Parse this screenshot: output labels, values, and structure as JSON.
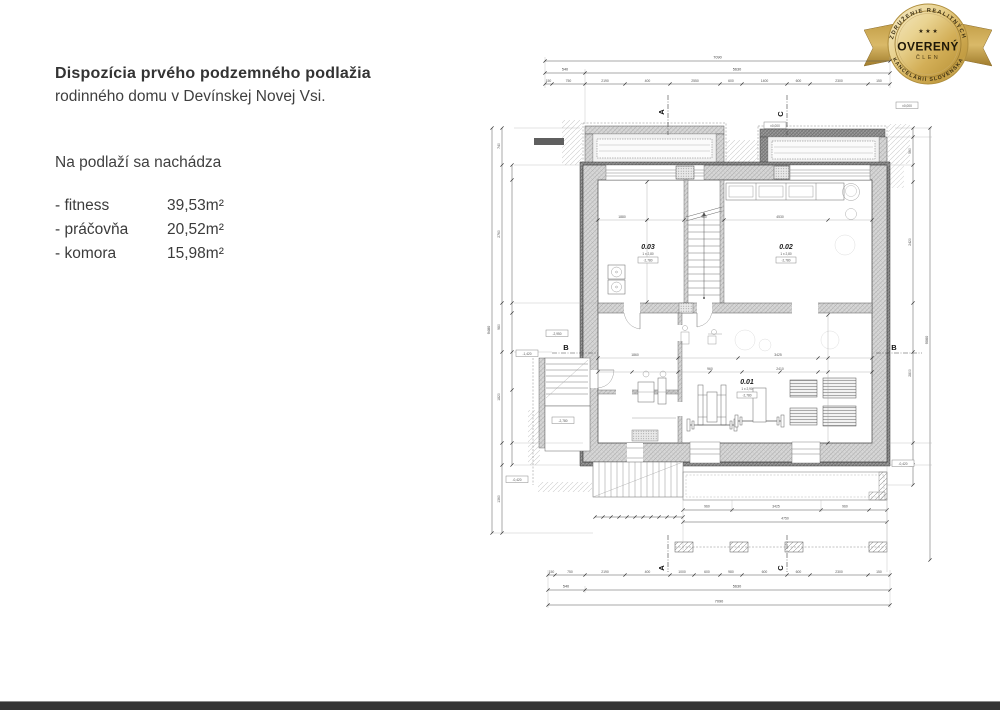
{
  "left_panel": {
    "title": "Dispozícia prvého podzemného podlažia",
    "subtitle": "rodinného domu v Devínskej Novej Vsi.",
    "heading": "Na podlaží sa nachádza",
    "rooms": [
      {
        "name": "- fitness",
        "area": "39,53m²"
      },
      {
        "name": "- práčovňa",
        "area": "20,52m²"
      },
      {
        "name": "- komora",
        "area": "15,98m²"
      }
    ]
  },
  "badge": {
    "top_arc": "ZDRUŽENIE REALITNÝCH",
    "bottom_arc": "KANCELÁRIÍ SLOVENSKA",
    "center": "OVERENÝ",
    "sub": "ČLEN",
    "stars": "★ ★ ★",
    "gold_dark": "#a07c2c",
    "gold_light": "#f6eccb",
    "text_color": "#2a2110"
  },
  "plan": {
    "sections": {
      "a": "A",
      "b": "B",
      "c": "C"
    },
    "room_labels": [
      {
        "id": "0.01",
        "line2": "1 x 2,90",
        "line3": "-2,780"
      },
      {
        "id": "0.02",
        "line2": "1 x 2,80",
        "line3": "-2,780"
      },
      {
        "id": "0.03",
        "line2": "1 x 2,80",
        "line3": "-2,780"
      }
    ],
    "elevation_boxes": [
      "±0,000",
      "±0,000",
      "-2,950",
      "-1,420",
      "-2,780",
      "-0,420",
      "-0,420"
    ],
    "dims": {
      "top_full": "7090",
      "top_mid": [
        "540",
        "5630"
      ],
      "top_detail": [
        "150",
        "750",
        "2190",
        "400",
        "2550",
        "600",
        "1400",
        "600",
        "2300",
        "150"
      ],
      "bottom_full": "7090",
      "bottom_mid": [
        "540",
        "5630"
      ],
      "bottom_detail": [
        "150",
        "750",
        "2190",
        "400",
        "1000",
        "600",
        "980",
        "600",
        "600",
        "2300",
        "150"
      ],
      "left_full": "9480",
      "left_mid": [
        "740",
        "2760",
        "980",
        "1820",
        "1360"
      ],
      "right_full": "9060",
      "right_mid": [
        "560",
        "2420",
        "2800",
        "840"
      ],
      "inner_top": [
        "1880",
        "980",
        "4530"
      ],
      "inner_mid": [
        "1860",
        "3425"
      ],
      "inner_mid2": [
        "960",
        "2410"
      ],
      "porch": [
        "960",
        "3425",
        "960"
      ],
      "porch_total": "4750"
    }
  }
}
